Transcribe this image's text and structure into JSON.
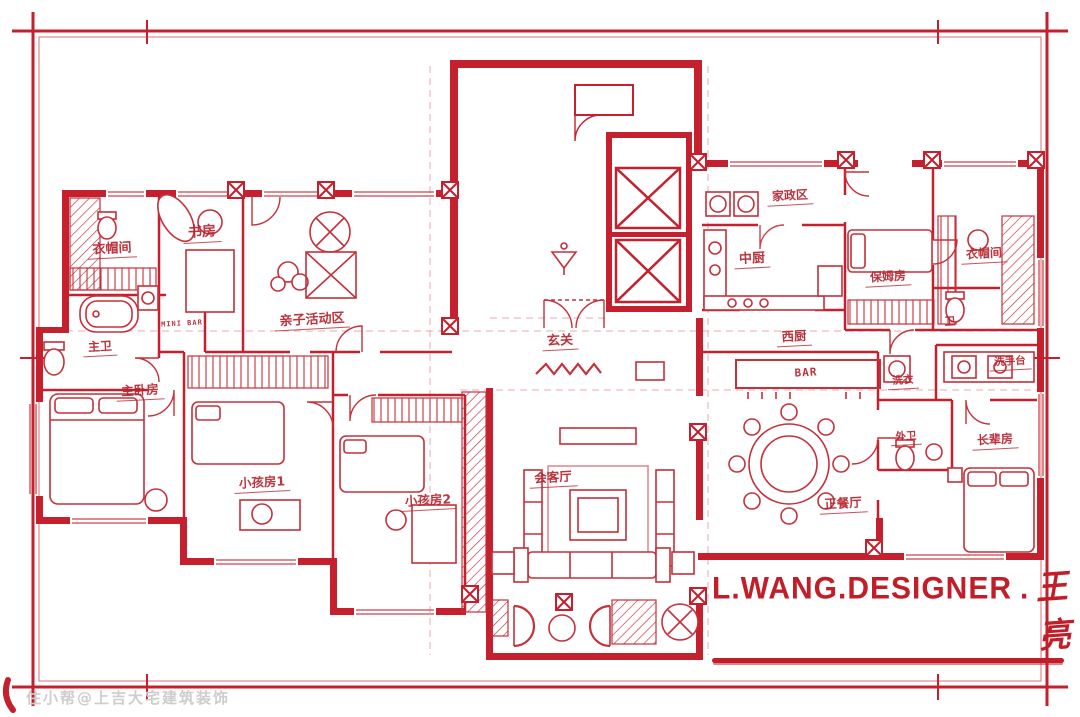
{
  "colors": {
    "ink": "#c5202e",
    "ink_light": "#d4555e",
    "label": "#b5242e",
    "watermark_gray": "#cdcdcd"
  },
  "plan": {
    "labels": [
      {
        "id": "closet-left",
        "text": "衣帽间"
      },
      {
        "id": "study",
        "text": "书房"
      },
      {
        "id": "kids-activity",
        "text": "亲子活动区"
      },
      {
        "id": "mini-bar",
        "text": "MINI BAR"
      },
      {
        "id": "master-bath",
        "text": "主卫"
      },
      {
        "id": "master-bedroom",
        "text": "主卧房"
      },
      {
        "id": "kids-room-1",
        "text": "小孩房1"
      },
      {
        "id": "kids-room-2",
        "text": "小孩房2"
      },
      {
        "id": "foyer",
        "text": "玄关"
      },
      {
        "id": "reception-room",
        "text": "会客厅"
      },
      {
        "id": "housekeeping",
        "text": "家政区"
      },
      {
        "id": "chinese-kitchen",
        "text": "中厨"
      },
      {
        "id": "nanny-room",
        "text": "保姆房"
      },
      {
        "id": "closet-right",
        "text": "衣帽间"
      },
      {
        "id": "western-kitchen",
        "text": "西厨"
      },
      {
        "id": "bar",
        "text": "BAR"
      },
      {
        "id": "bathroom",
        "text": "卫"
      },
      {
        "id": "laundry",
        "text": "洗衣"
      },
      {
        "id": "wash-counter",
        "text": "洗手台"
      },
      {
        "id": "guest-bath",
        "text": "外卫"
      },
      {
        "id": "elders-room",
        "text": "长辈房"
      },
      {
        "id": "formal-dining",
        "text": "正餐厅"
      }
    ]
  },
  "signature": {
    "latin": "L.WANG.DESIGNER",
    "separator": ".",
    "name": "王亮"
  },
  "watermark": {
    "text": "住小帮@上吉大宅建筑装饰"
  }
}
